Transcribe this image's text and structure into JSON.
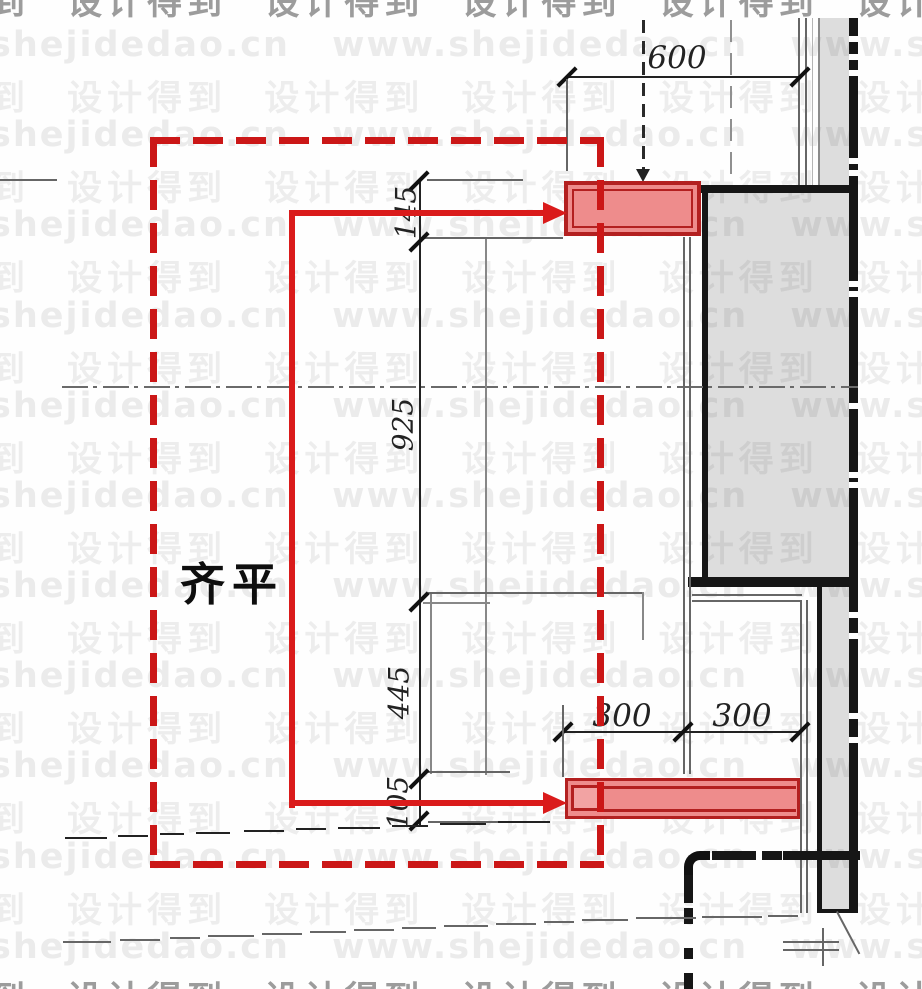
{
  "drawing": {
    "flush_label": "齐平",
    "dimensions": {
      "top_width": "600",
      "vertical_stack": [
        {
          "name": "top-panel-height",
          "value": "145"
        },
        {
          "name": "opening-height",
          "value": "925"
        },
        {
          "name": "desk-to-base-height",
          "value": "445"
        },
        {
          "name": "base-panel-height",
          "value": "105"
        }
      ],
      "niche_depth": [
        "300",
        "300"
      ]
    },
    "colors": {
      "highlight_fill": "#ee8c8c",
      "highlight_border": "#b32020",
      "annotation_red": "#da1b1b",
      "dashed_box_red": "#cb1717",
      "wall_gray": "#d8d8d8",
      "line_black": "#1a1a1a"
    }
  },
  "watermark": {
    "latin": "shejidedao.cn      www.shejidedao.cn      www.shejidedao.cn",
    "cjk": "到  设计得到  设计得到  设计得到  设计得到  设计得到  设计得",
    "rows": [
      {
        "lang": "cjk",
        "y": -26,
        "dark": true
      },
      {
        "lang": "latin",
        "y": 25,
        "dark": false
      },
      {
        "lang": "cjk",
        "y": 70,
        "dark": false
      },
      {
        "lang": "latin",
        "y": 115,
        "dark": false
      },
      {
        "lang": "cjk",
        "y": 160,
        "dark": false
      },
      {
        "lang": "latin",
        "y": 205,
        "dark": false
      },
      {
        "lang": "cjk",
        "y": 250,
        "dark": false
      },
      {
        "lang": "latin",
        "y": 296,
        "dark": false
      },
      {
        "lang": "cjk",
        "y": 341,
        "dark": false
      },
      {
        "lang": "latin",
        "y": 386,
        "dark": false
      },
      {
        "lang": "cjk",
        "y": 431,
        "dark": false
      },
      {
        "lang": "latin",
        "y": 476,
        "dark": false
      },
      {
        "lang": "cjk",
        "y": 521,
        "dark": false
      },
      {
        "lang": "latin",
        "y": 566,
        "dark": false
      },
      {
        "lang": "cjk",
        "y": 611,
        "dark": false
      },
      {
        "lang": "latin",
        "y": 656,
        "dark": false
      },
      {
        "lang": "cjk",
        "y": 701,
        "dark": false
      },
      {
        "lang": "latin",
        "y": 746,
        "dark": false
      },
      {
        "lang": "cjk",
        "y": 791,
        "dark": false
      },
      {
        "lang": "latin",
        "y": 837,
        "dark": false
      },
      {
        "lang": "cjk",
        "y": 882,
        "dark": false
      },
      {
        "lang": "latin",
        "y": 927,
        "dark": false
      },
      {
        "lang": "cjk",
        "y": 971,
        "dark": true
      }
    ]
  }
}
